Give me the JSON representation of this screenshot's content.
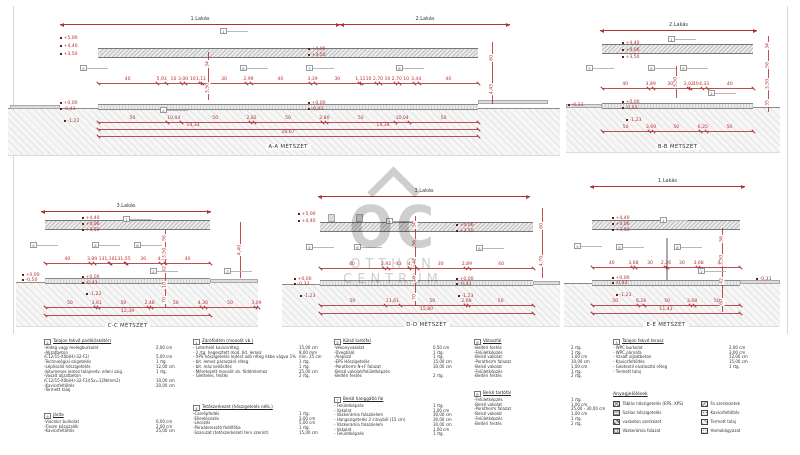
{
  "page": {
    "background": "#ffffff",
    "dim_color": "#b03131",
    "line_color": "#8c8c8c",
    "title_color": "#333333"
  },
  "watermark": {
    "logo_text": "OC",
    "line1": "OTTHON",
    "line2": "CENTRUM"
  },
  "sections": [
    {
      "id": "aa",
      "title": "A-A METSZET",
      "span_labels": [
        "1.Lakás",
        "2.Lakás"
      ],
      "elev_groups": [
        [
          "+5,00",
          "+4,40",
          "+3,50"
        ],
        [
          "+4,06",
          "+3,50"
        ],
        [
          "+0,00",
          "-0,43"
        ],
        [
          "+0,00",
          "-0,43"
        ],
        [
          "-1,22"
        ]
      ],
      "mid_dims": [
        "40",
        "5,93",
        "10",
        "3,00",
        "10",
        "1,11",
        "30",
        "2,99",
        "40",
        "3,39",
        "30",
        "1,11",
        "10",
        "2,70",
        "10",
        "2,70",
        "10",
        "3,44",
        "40"
      ],
      "bottom_dims": [
        "50",
        "10,04",
        "50",
        "2,82",
        "50",
        "2,80",
        "50",
        "10,04",
        "50"
      ],
      "subtotals": [
        "14,33",
        "14,34"
      ],
      "total": "28,67",
      "right_dims": [
        "60",
        "4,45"
      ],
      "center_dims": [
        "34",
        "3,50"
      ],
      "refs": [
        "1",
        "5",
        "8",
        "7",
        "6",
        "2"
      ]
    },
    {
      "id": "bb",
      "title": "B-B METSZET",
      "span_labels": [
        "2.Lakás"
      ],
      "elev_groups": [
        [
          "+4,40",
          "+4,06",
          "+3,50"
        ],
        [
          "+0,00",
          "-0,43"
        ],
        [
          "-1,23"
        ],
        [
          "-0,33"
        ]
      ],
      "mid_dims": [
        "40",
        "3,89",
        "30",
        "2,02",
        "10",
        "4,33",
        "40"
      ],
      "bottom_dims": [
        "50",
        "3,69",
        "50",
        "6,25",
        "50"
      ],
      "subtotals": [],
      "total": "",
      "right_dims": [
        "34",
        "56",
        "3,50",
        "35"
      ],
      "center_dims": [
        "3,50"
      ],
      "refs": [
        "1",
        "5",
        "8",
        "6",
        "2"
      ]
    },
    {
      "id": "cc",
      "title": "C-C METSZET",
      "span_labels": [
        "3.Lakás"
      ],
      "elev_groups": [
        [
          "+4,40",
          "+4,06",
          "+3,50"
        ],
        [
          "+0,00",
          "-0,43"
        ],
        [
          "-1,23"
        ],
        [
          "+0,00",
          "-0,50"
        ]
      ],
      "mid_dims": [
        "40",
        "3,89",
        "13",
        "1,10",
        "13",
        "1,55",
        "30",
        "4,50",
        "40"
      ],
      "bottom_dims": [
        "50",
        "3,61",
        "50",
        "2,48",
        "50",
        "4,30",
        "50",
        "3,09"
      ],
      "subtotals": [
        "12,39"
      ],
      "total": "",
      "right_dims": [
        "4,40"
      ],
      "center_dims": [
        "56",
        "3,50",
        "42",
        "10",
        "70"
      ],
      "refs": [
        "1",
        "5",
        "6",
        "8",
        "2",
        "3"
      ]
    },
    {
      "id": "dd",
      "title": "D-D METSZET",
      "span_labels": [
        "3.Lakás"
      ],
      "elev_groups": [
        [
          "+5,00",
          "+4,40"
        ],
        [
          "+4,06",
          "+3,50"
        ],
        [
          "+0,00",
          "-0,33"
        ],
        [
          "+0,00",
          "-0,43"
        ],
        [
          "-1,23"
        ],
        [
          "-1,23"
        ]
      ],
      "mid_dims": [
        "40",
        "2,92",
        "13",
        "4,77",
        "30",
        "2,89",
        "40"
      ],
      "bottom_dims": [
        "50",
        "11,61",
        "50",
        "2,69",
        "50"
      ],
      "subtotals": [
        "15,80"
      ],
      "total": "",
      "right_dims": [
        "60",
        "4,70"
      ],
      "center_dims": [
        "34",
        "56",
        "42",
        "10",
        "70"
      ],
      "refs": [
        "1",
        "5",
        "6",
        "8"
      ]
    },
    {
      "id": "ee",
      "title": "E-E METSZET",
      "span_labels": [
        "1.Lakás"
      ],
      "elev_groups": [
        [
          "+4,40",
          "+4,06",
          "+3,50"
        ],
        [
          "+0,00",
          "-0,43"
        ],
        [
          "-1,23"
        ],
        [
          "-0,33"
        ]
      ],
      "mid_dims": [
        "40",
        "3,68",
        "30",
        "2,26",
        "30",
        "3,68",
        "40"
      ],
      "bottom_dims": [
        "50",
        "6,26",
        "50",
        "3,68",
        "50"
      ],
      "subtotals": [],
      "total": "11,43",
      "right_dims": [
        "56",
        "3,50",
        "42",
        "60"
      ],
      "center_dims": [],
      "refs": [
        "1",
        "5",
        "6",
        "8",
        "2"
      ]
    }
  ],
  "legend_blocks": [
    {
      "num": "2",
      "title": "Talajon fekvő padló(lakótér)",
      "items": [
        [
          "-Hideg vagy melegburkolat",
          "2,00 cm"
        ],
        [
          "-Aljzatbeton",
          ""
        ],
        [
          "/C12/15-X0b(H)-32-F2/",
          "5,00 cm"
        ],
        [
          "-Technológiai szigetelés",
          "1 rtg."
        ],
        [
          "-Lépésálló hőszigetelés",
          "12,00 cm"
        ],
        [
          "-bitumenes lemez talajnedv. elleni szig.",
          "1 rtg."
        ],
        [
          "-Vasalt aljzatbeton",
          ""
        ],
        [
          "/C12/15-X0b(H)-32-F2/(5x=12N/mm2)",
          "10,00 cm"
        ],
        [
          "-Kavicsfeltöltés",
          "20,00 cm"
        ],
        [
          "-Termett talaj",
          ""
        ]
      ]
    },
    {
      "num": "9",
      "title": "Járda",
      "items": [
        [
          "-Viacolor burkolat",
          "6,00 cm"
        ],
        [
          "-Finom kőzúzalék",
          "2,00 cm"
        ],
        [
          "-Kavicsfeltöltés",
          "25,00 cm"
        ]
      ]
    },
    {
      "num": "1",
      "title": "Zárófödém (monolit vb.)",
      "items": [
        [
          "- Leterhelő kavicsréteg",
          "15,00 cm"
        ],
        [
          "- 2 rtg. hegesztett mod. bit. lemez",
          "8,00 mm"
        ],
        [
          "- XPS hőszigetelés lejtést adó réteg ékbe vágva 1%",
          "min. 25 cm"
        ],
        [
          "- bit. lemez páraszáró réteg",
          "1 rtg."
        ],
        [
          "- bit. máz kellősítés",
          "1 rtg."
        ],
        [
          "- Méretezett monolit vb. födémlemez",
          "25,00 cm"
        ],
        [
          "- Glettelés, festés",
          "2 rtg."
        ]
      ]
    },
    {
      "num": "4",
      "title": "Tetőszerkezet (hőszigetelés nélk.)",
      "items": [
        [
          "-Cserépfedés",
          "1 rtg."
        ],
        [
          "-Ellenlécezés",
          "3,00 cm"
        ],
        [
          "-Lécezés",
          "5,00 cm"
        ],
        [
          "-Páraáteresztő fedőfólia",
          "1 rtg."
        ],
        [
          "-Szaruzat (tetőszerkezeti terv szerint)",
          "15,00 cm"
        ]
      ]
    },
    {
      "num": "5",
      "title": "Külső tartófal",
      "items": [
        [
          "-Vékonyvakolat",
          "0,50 cm"
        ],
        [
          "-Üvegháló",
          "1 rtg."
        ],
        [
          "-Alapozó",
          "1 rtg."
        ],
        [
          "-EPS Hőszigetelés",
          "15,00 cm"
        ],
        [
          "-Porotherm N+F falazat",
          "30,00 cm"
        ],
        [
          "-Belső vakolat/felületképzés",
          ""
        ],
        [
          "-Beltéri festés",
          "2 rtg."
        ]
      ]
    },
    {
      "num": "7",
      "title": "Belső hanggátló fal",
      "items": [
        [
          "- Felületképzés",
          "1 rtg."
        ],
        [
          "- Vakolat",
          "1,00 cm"
        ],
        [
          "- Vázkerámia falazóelem",
          "30,00 cm"
        ],
        [
          "- Hangszigetelés 2 irányból (15 cm)",
          "30,00 cm"
        ],
        [
          "- Vázkerámia falazóelem",
          "30,00 cm"
        ],
        [
          "- Vakolat",
          "1,00 cm"
        ],
        [
          "- Felületképzés",
          "1 rtg."
        ]
      ]
    },
    {
      "num": "6",
      "title": "Válaszfal",
      "items": [
        [
          "-Beltéri festés",
          "2 rtg."
        ],
        [
          "-Felületképzés",
          "1 rtg."
        ],
        [
          "-Belső vakolat",
          "1,00 cm"
        ],
        [
          "-Porotherm falazat",
          "10,00 cm"
        ],
        [
          "-Belső vakolat",
          "1,00 cm"
        ],
        [
          "-Felületképzés",
          "1 rtg."
        ],
        [
          "-Beltéri festés",
          "2 rtg."
        ]
      ]
    },
    {
      "num": "8",
      "title": "Belső tartófal",
      "items": [
        [
          "-Felületképzés",
          "1 rtg."
        ],
        [
          "-Belső vakolat",
          "1,00 cm"
        ],
        [
          "-Porotherm falazat",
          "25,00 - 30,00 cm"
        ],
        [
          "-Belső vakolat",
          "1,00 cm"
        ],
        [
          "-Felületképzés",
          "1 rtg."
        ],
        [
          "-Beltéri festés",
          "2 rtg."
        ]
      ]
    },
    {
      "num": "3",
      "title": "Talajon fekvő terasz",
      "items": [
        [
          "- WPC burkolat",
          "2,00 cm"
        ],
        [
          "- WPC párnafa",
          "3,00 cm"
        ],
        [
          "- Vasalt aljzatbeton",
          "12,00 cm"
        ],
        [
          "- Kavicsfeltöltés",
          "15,00 cm"
        ],
        [
          "- Geotextil elválasztó réteg",
          "1 rtg."
        ],
        [
          "- Termett talaj",
          ""
        ]
      ]
    }
  ],
  "materials": {
    "title": "Anyagjelölések",
    "left": [
      {
        "label": "Táblás hőszigetelés (EPS, XPS)",
        "pattern": "board-insulation-swatch"
      },
      {
        "label": "Szálas hőszigetelés",
        "pattern": "fiber-insulation-swatch"
      },
      {
        "label": "vasbeton szerkezet",
        "pattern": "reinforced-concrete-swatch"
      },
      {
        "label": "Vázkerámia falazat",
        "pattern": "clay-block-swatch"
      }
    ],
    "right": [
      {
        "label": "Fa szerkezetek",
        "pattern": "wood-swatch"
      },
      {
        "label": "Kavicsfeltöltés",
        "pattern": "gravel-swatch"
      },
      {
        "label": "Termett talaj",
        "pattern": "soil-swatch"
      },
      {
        "label": "Homokágyazat",
        "pattern": "sand-swatch"
      }
    ]
  }
}
